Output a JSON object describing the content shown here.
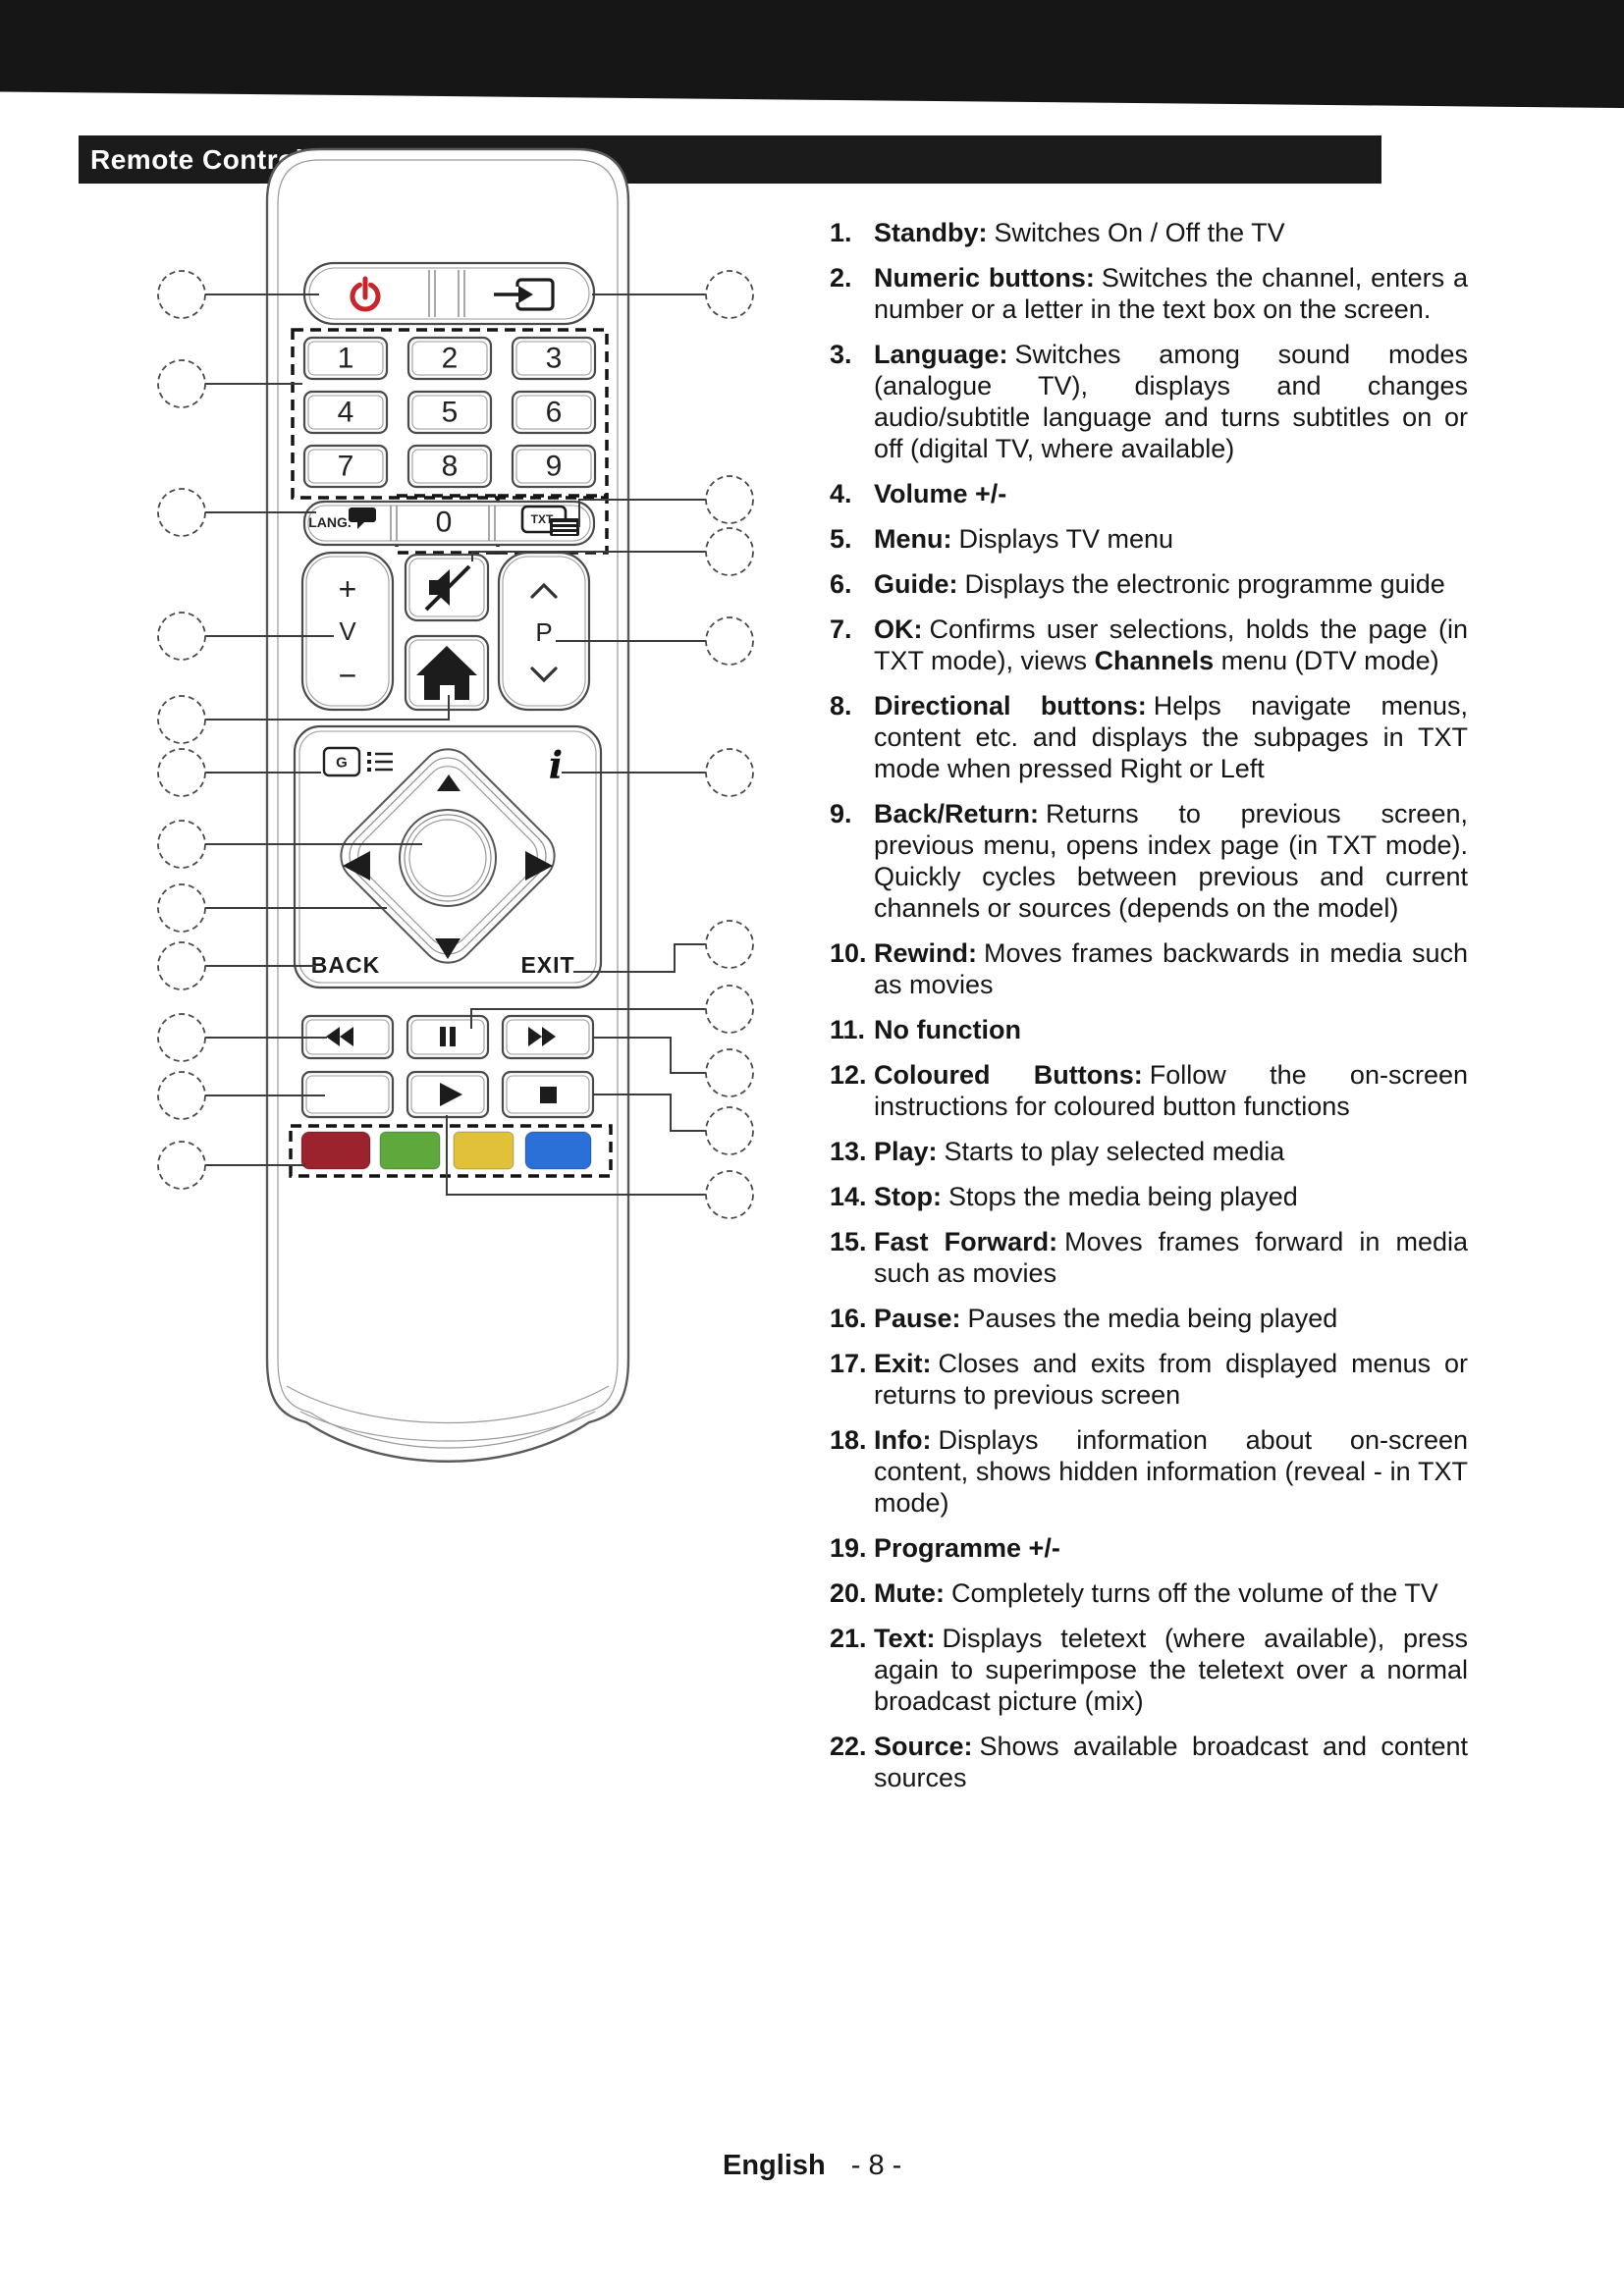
{
  "header": {
    "title": "Remote Control"
  },
  "remote": {
    "keys": {
      "digits": [
        "1",
        "2",
        "3",
        "4",
        "5",
        "6",
        "7",
        "8",
        "9"
      ],
      "zero": "0",
      "lang": "LANG.",
      "txt": "TXT",
      "volume_plus": "+",
      "volume_letter": "V",
      "volume_minus": "−",
      "programme_letter": "P",
      "guide_letter": "G",
      "info_letter": "i",
      "back": "BACK",
      "exit": "EXIT"
    },
    "icons": [
      "power-icon",
      "source-icon",
      "speech-bubble-icon",
      "teletext-icon",
      "mute-icon",
      "home-icon",
      "chevron-up-icon",
      "chevron-down-icon",
      "guide-icon",
      "info-icon",
      "arrow-up-icon",
      "arrow-down-icon",
      "arrow-left-icon",
      "arrow-right-icon",
      "ok-circle",
      "rewind-icon",
      "pause-icon",
      "fast-forward-icon",
      "play-icon",
      "stop-icon"
    ],
    "colours": {
      "power_red": "#C4262C",
      "red": "#9B232D",
      "green": "#5FA83C",
      "yellow": "#E1C13A",
      "blue": "#2B70D6"
    }
  },
  "list": {
    "items": [
      {
        "num": "1.",
        "label": "Standby:",
        "desc": "Switches On / Off the TV"
      },
      {
        "num": "2.",
        "label": "Numeric buttons:",
        "desc": "Switches the channel, enters a number or a letter in the text box on the screen."
      },
      {
        "num": "3.",
        "label": "Language:",
        "desc": "Switches among sound modes (analogue TV), displays and changes audio/subtitle language and turns subtitles on or off (digital TV, where available)"
      },
      {
        "num": "4.",
        "label": "Volume +/-",
        "desc": ""
      },
      {
        "num": "5.",
        "label": "Menu:",
        "desc": "Displays TV menu"
      },
      {
        "num": "6.",
        "label": "Guide:",
        "desc": "Displays the electronic programme guide"
      },
      {
        "num": "7.",
        "label": "OK:",
        "desc": "Confirms user selections, holds the page (in TXT mode), views **Channels** menu (DTV mode)"
      },
      {
        "num": "8.",
        "label": "Directional buttons:",
        "desc": "Helps navigate menus, content etc. and displays the subpages in TXT mode when pressed Right or Left"
      },
      {
        "num": "9.",
        "label": "Back/Return:",
        "desc": "Returns to previous screen, previous menu, opens index page (in TXT mode). Quickly cycles between previous and current channels or sources (depends on the model)"
      },
      {
        "num": "10.",
        "label": "Rewind:",
        "desc": "Moves frames backwards in media such as movies"
      },
      {
        "num": "11.",
        "label": "No function",
        "desc": ""
      },
      {
        "num": "12.",
        "label": "Coloured Buttons:",
        "desc": "Follow the on-screen instructions for coloured button functions"
      },
      {
        "num": "13.",
        "label": "Play:",
        "desc": "Starts to play selected media"
      },
      {
        "num": "14.",
        "label": "Stop:",
        "desc": "Stops the media being played"
      },
      {
        "num": "15.",
        "label": "Fast Forward:",
        "desc": "Moves frames forward in media such as movies"
      },
      {
        "num": "16.",
        "label": "Pause:",
        "desc": "Pauses the media being played"
      },
      {
        "num": "17.",
        "label": "Exit:",
        "desc": "Closes and exits from displayed menus or returns to previous screen"
      },
      {
        "num": "18.",
        "label": "Info:",
        "desc": "Displays information about on-screen content, shows hidden information (reveal - in TXT mode)"
      },
      {
        "num": "19.",
        "label": "Programme +/-",
        "desc": ""
      },
      {
        "num": "20.",
        "label": "Mute:",
        "desc": "Completely turns off the volume of the TV"
      },
      {
        "num": "21.",
        "label": "Text:",
        "desc": "Displays teletext (where available), press again to superimpose the teletext over a normal broadcast picture (mix)"
      },
      {
        "num": "22.",
        "label": "Source:",
        "desc": "Shows available broadcast and content sources"
      }
    ]
  },
  "footer": {
    "language_label": "English",
    "page_label": "- 8 -"
  }
}
